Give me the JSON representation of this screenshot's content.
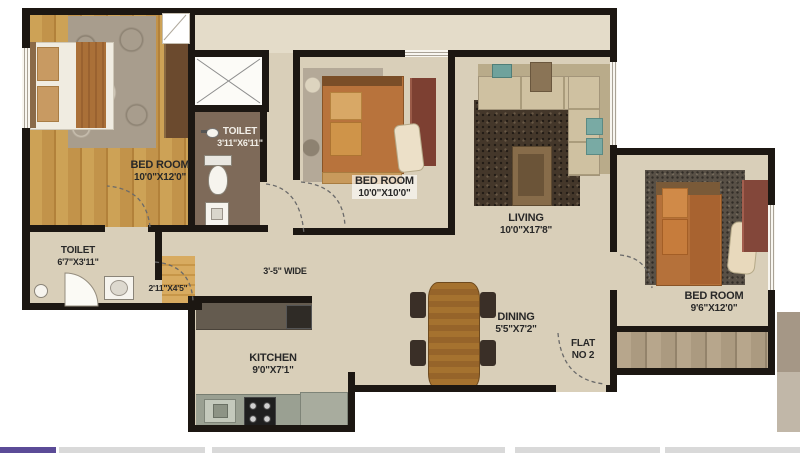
{
  "colors": {
    "wall": "#1c1712",
    "floor": "#d9cfb9",
    "floor_light": "#e4dcc9",
    "toilet_floor": "#7e6a59",
    "accent_purple": "#5b4b97",
    "track_gray": "#d9d9d9",
    "label_ink": "#282828"
  },
  "floorplan": {
    "rooms": {
      "bedroom1": {
        "name": "BED ROOM",
        "dims": "10'0\"X12'0\""
      },
      "toilet_top": {
        "name": "TOILET",
        "dims": "3'11\"X6'11\""
      },
      "bedroom2": {
        "name": "BED ROOM",
        "dims": "10'0\"X10'0\""
      },
      "living": {
        "name": "LIVING",
        "dims": "10'0\"X17'8\""
      },
      "bedroom3": {
        "name": "BED ROOM",
        "dims": "9'6\"X12'0\""
      },
      "toilet_left": {
        "name": "TOILET",
        "dims": "6'7\"X3'11\""
      },
      "kitchen": {
        "name": "KITCHEN",
        "dims": "9'0\"X7'1\""
      },
      "dining": {
        "name": "DINING",
        "dims": "5'5\"X7'2\""
      }
    },
    "passages": {
      "corridor_width": "3'-5\" WIDE",
      "lobby_dims": "2'11\"X4'5\""
    },
    "flat": {
      "line1": "FLAT",
      "line2": "NO 2"
    }
  }
}
